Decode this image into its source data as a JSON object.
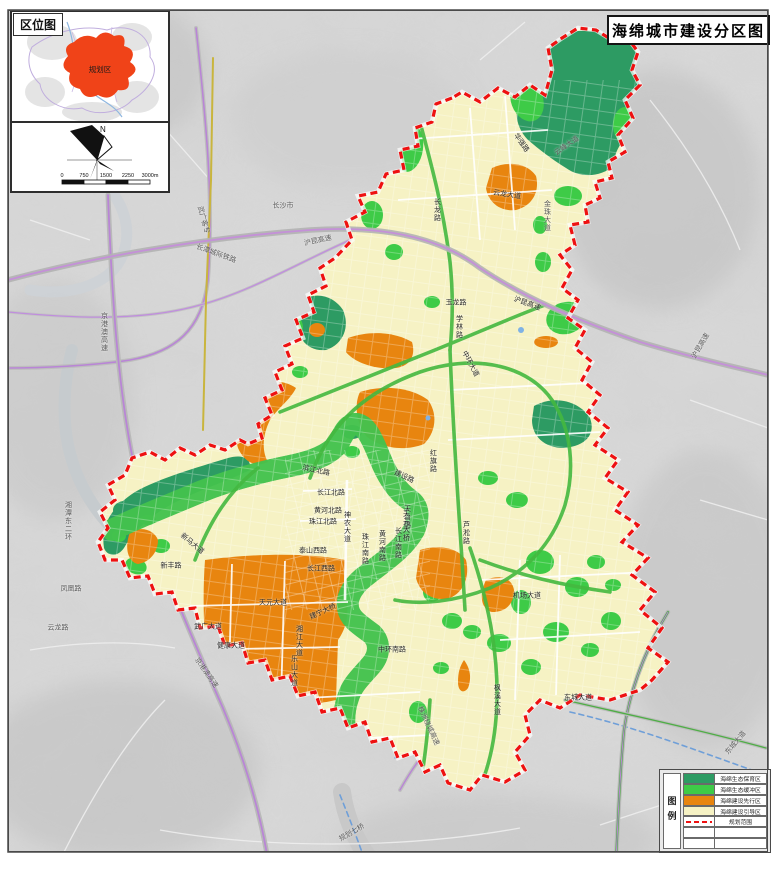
{
  "title": "海绵城市建设分区图",
  "inset": {
    "tag": "区位图",
    "region_label": "规划区"
  },
  "compass": {
    "north_label": "N"
  },
  "scale_bar": {
    "ticks": [
      "0",
      "750",
      "1500",
      "2250",
      "3000m"
    ]
  },
  "legend": {
    "heading": "图例",
    "items": [
      {
        "label": "海绵生态保育区",
        "color": "#2d9b63",
        "type": "fill"
      },
      {
        "label": "海绵生态缓冲区",
        "color": "#3ecb47",
        "type": "fill"
      },
      {
        "label": "海绵建设先行区",
        "color": "#e8850f",
        "type": "fill"
      },
      {
        "label": "海绵建设引导区",
        "color": "#f6f2c4",
        "type": "fill"
      },
      {
        "label": "规划范围",
        "color": "#ee1111",
        "type": "dashed-line"
      },
      {
        "label": "",
        "type": "empty"
      },
      {
        "label": "",
        "type": "empty"
      }
    ]
  },
  "colors": {
    "boundary_red": "#ee1111",
    "river_teal": "#2b8e63",
    "greenway": "#44c24e",
    "railway_purple": "#b985d6",
    "terrain_gray": "#d8d8d8",
    "urban_yellow": "#f6f2c4"
  },
  "map_labels": [
    {
      "t": "云龙大道",
      "x": 507,
      "y": 195,
      "r": 8
    },
    {
      "t": "华强路",
      "x": 521,
      "y": 143,
      "r": 55
    },
    {
      "t": "长龙路",
      "x": 437,
      "y": 210,
      "v": 1
    },
    {
      "t": "玉龙路",
      "x": 456,
      "y": 303
    },
    {
      "t": "学林路",
      "x": 459,
      "y": 327,
      "v": 1
    },
    {
      "t": "中环大道",
      "x": 470,
      "y": 364,
      "r": 62
    },
    {
      "t": "沪昆高速",
      "x": 527,
      "y": 304,
      "r": 20
    },
    {
      "t": "建设路",
      "x": 404,
      "y": 477,
      "r": 25
    },
    {
      "t": "天台路",
      "x": 407,
      "y": 517,
      "v": 1
    },
    {
      "t": "滨江北路",
      "x": 316,
      "y": 471,
      "r": 12
    },
    {
      "t": "长江北路",
      "x": 331,
      "y": 493
    },
    {
      "t": "黄河北路",
      "x": 328,
      "y": 511
    },
    {
      "t": "珠江北路",
      "x": 323,
      "y": 522
    },
    {
      "t": "神农大道",
      "x": 347,
      "y": 527,
      "v": 1
    },
    {
      "t": "泰山西路",
      "x": 313,
      "y": 551
    },
    {
      "t": "长江西路",
      "x": 321,
      "y": 569
    },
    {
      "t": "珠江南路",
      "x": 365,
      "y": 549,
      "v": 1
    },
    {
      "t": "黄河南路",
      "x": 382,
      "y": 546,
      "v": 1
    },
    {
      "t": "长江南路",
      "x": 398,
      "y": 543,
      "v": 1
    },
    {
      "t": "红旗路",
      "x": 433,
      "y": 461,
      "v": 1
    },
    {
      "t": "天元大桥",
      "x": 406,
      "y": 526,
      "v": 1
    },
    {
      "t": "芦淞路",
      "x": 466,
      "y": 533,
      "v": 1
    },
    {
      "t": "天元大道",
      "x": 273,
      "y": 603
    },
    {
      "t": "武广大道",
      "x": 208,
      "y": 627
    },
    {
      "t": "健康大道",
      "x": 231,
      "y": 646
    },
    {
      "t": "湘江大道",
      "x": 299,
      "y": 641,
      "v": 1
    },
    {
      "t": "乐山大道",
      "x": 294,
      "y": 671,
      "v": 1
    },
    {
      "t": "建宁大桥",
      "x": 323,
      "y": 612,
      "r": -25
    },
    {
      "t": "中环南路",
      "x": 392,
      "y": 650
    },
    {
      "t": "机场大道",
      "x": 527,
      "y": 596
    },
    {
      "t": "东城大道",
      "x": 578,
      "y": 698
    },
    {
      "t": "新马大道",
      "x": 192,
      "y": 544,
      "r": 40
    },
    {
      "t": "新丰路",
      "x": 171,
      "y": 566
    },
    {
      "t": "枫溪大道",
      "x": 497,
      "y": 700,
      "v": 1
    },
    {
      "t": "长沙市",
      "x": 283,
      "y": 206,
      "out": 1
    },
    {
      "t": "武广客专",
      "x": 203,
      "y": 220,
      "r": 75,
      "out": 1
    },
    {
      "t": "长潭城际铁路",
      "x": 216,
      "y": 254,
      "r": 20,
      "out": 1
    },
    {
      "t": "沪昆高速",
      "x": 318,
      "y": 241,
      "r": -12,
      "out": 1
    },
    {
      "t": "京港澳高速",
      "x": 104,
      "y": 332,
      "v": 1,
      "out": 1
    },
    {
      "t": "京港澳高速",
      "x": 206,
      "y": 673,
      "r": 55,
      "out": 1
    },
    {
      "t": "湘潭东二环",
      "x": 68,
      "y": 521,
      "v": 1,
      "out": 1
    },
    {
      "t": "凤凰路",
      "x": 71,
      "y": 589,
      "out": 1
    },
    {
      "t": "云龙路",
      "x": 58,
      "y": 628,
      "out": 1
    },
    {
      "t": "金珠大道",
      "x": 547,
      "y": 216,
      "v": 1,
      "out": 1
    },
    {
      "t": "云峰大道",
      "x": 567,
      "y": 146,
      "r": -35,
      "out": 1
    },
    {
      "t": "东城大道",
      "x": 736,
      "y": 743,
      "r": -50,
      "out": 1
    },
    {
      "t": "沪昆高速",
      "x": 701,
      "y": 346,
      "r": -60,
      "out": 1
    },
    {
      "t": "株洲绕城高速",
      "x": 428,
      "y": 726,
      "r": 65,
      "out": 1
    },
    {
      "t": "规划七桥",
      "x": 352,
      "y": 833,
      "r": -30,
      "out": 1
    }
  ]
}
